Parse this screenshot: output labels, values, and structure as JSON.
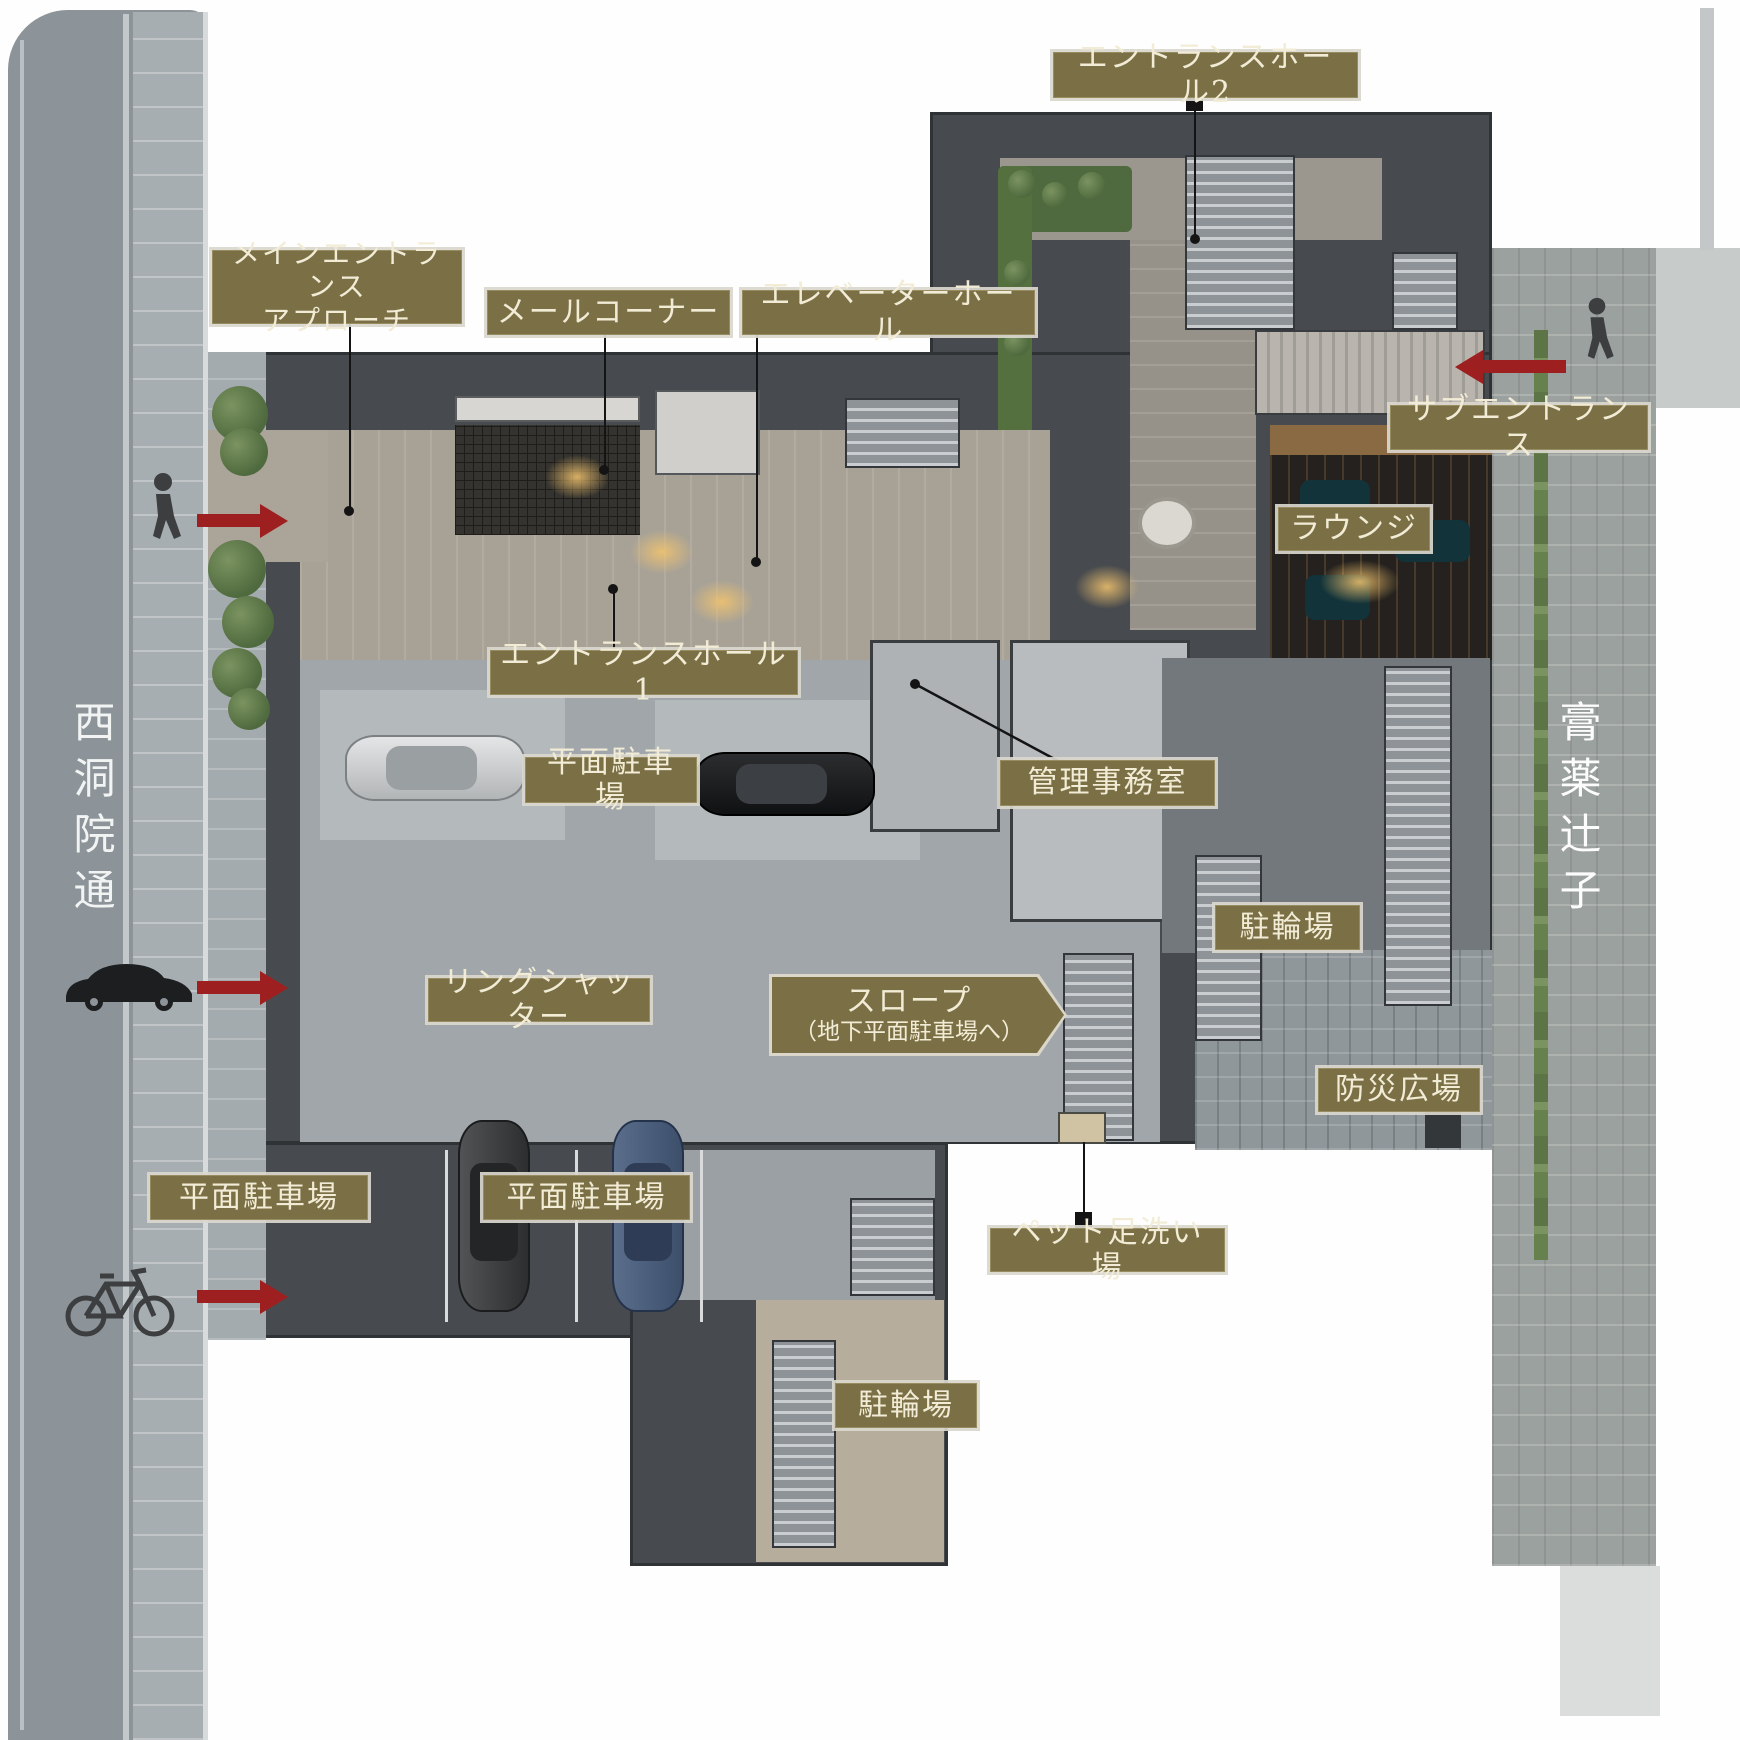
{
  "diagram": {
    "type": "residence-site-plan",
    "streets": {
      "left": {
        "name": "西洞院通"
      },
      "right": {
        "name": "膏薬辻子"
      }
    },
    "labels": {
      "entrance_hall_2": "エントランスホール2",
      "main_entrance_approach_line1": "メインエントランス",
      "main_entrance_approach_line2": "アプローチ",
      "mail_corner": "メールコーナー",
      "elevator_hall": "エレベーターホール",
      "sub_entrance": "サブエントランス",
      "lounge": "ラウンジ",
      "entrance_hall_1": "エントランスホール1",
      "flat_parking_mid": "平面駐車場",
      "management_office": "管理事務室",
      "bicycle_parking_right": "駐輪場",
      "ring_shutter": "リングシャッター",
      "slope_line1": "スロープ",
      "slope_line2": "（地下平面駐車場へ）",
      "disaster_plaza": "防災広場",
      "pet_foot_wash": "ペット足洗い場",
      "flat_parking_left": "平面駐車場",
      "flat_parking_bottom": "平面駐車場",
      "bicycle_parking_bottom": "駐輪場"
    },
    "entries": [
      {
        "icon": "pedestrian-icon",
        "arrow_direction": "right",
        "location": "west-street-main-entrance"
      },
      {
        "icon": "car-icon",
        "arrow_direction": "right",
        "location": "west-street-parking-entrance"
      },
      {
        "icon": "bicycle-icon",
        "arrow_direction": "right",
        "location": "west-street-bicycle-entrance"
      },
      {
        "icon": "pedestrian-icon",
        "arrow_direction": "left",
        "location": "east-alley-sub-entrance"
      }
    ],
    "colors": {
      "label_bg": "#7b7045",
      "label_text": "#f2ecd6",
      "label_outline": "#dad7ca",
      "leader_line": "#141414",
      "arrow_red": "#9e1f1f",
      "road": "#8c9499",
      "sidewalk": "#a7aeb1",
      "alley_paving": "#9ba19e",
      "building_wall": "#474a4e",
      "parking_floor": "#a0a6aa",
      "hall_stone_floor": "#a8a296",
      "lounge_wood": "#8a6a42",
      "plaza_paving": "#8f979a",
      "bicycle_area": "#b6ad9c",
      "greenery": "#5d7547"
    }
  }
}
